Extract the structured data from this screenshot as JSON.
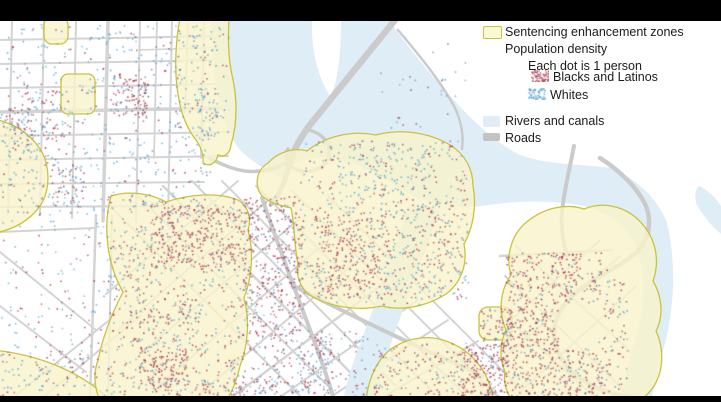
{
  "legend": {
    "items": [
      {
        "label": "Sentencing enhancement zones",
        "swatch": "zone-swatch"
      },
      {
        "label": "Population density",
        "swatch": null
      },
      {
        "label": "Each dot is 1 person",
        "swatch": null
      },
      {
        "label": "Blacks and Latinos",
        "swatch": "red-dots-swatch"
      },
      {
        "label": "Whites",
        "swatch": "blue-dots-swatch"
      },
      {
        "label": "Rivers and canals",
        "swatch": "river-swatch"
      },
      {
        "label": "Roads",
        "swatch": "road-swatch"
      }
    ]
  },
  "colors": {
    "zone_fill": "#F7F3CB",
    "zone_border": "#C9C33C",
    "zone_swatch_fill": "#FBF8D8",
    "river": "#DFEDF6",
    "road": "#D2D2D2",
    "road_major": "#CBCBCB",
    "dot_red": "#A93B50",
    "dot_blue": "#5AA2D0",
    "frame_bar": "#000000",
    "legend_text": "#1B1B1B"
  },
  "map": {
    "dot_unit_label": "Each dot is 1 person",
    "dot_size": 1.5,
    "dot_regions": [
      {
        "name": "grid-main",
        "x": 4,
        "y": 24,
        "w": 206,
        "h": 190,
        "n": 480,
        "red": 0.2
      },
      {
        "name": "red-cluster-a",
        "x": 112,
        "y": 74,
        "w": 36,
        "h": 44,
        "n": 95,
        "red": 0.85
      },
      {
        "name": "red-cluster-b",
        "x": 26,
        "y": 90,
        "w": 42,
        "h": 48,
        "n": 70,
        "red": 0.5
      },
      {
        "name": "red-cluster-c",
        "x": 50,
        "y": 163,
        "w": 34,
        "h": 44,
        "n": 60,
        "red": 0.55
      },
      {
        "name": "red-cluster-d",
        "x": 0,
        "y": 106,
        "w": 28,
        "h": 36,
        "n": 40,
        "red": 0.5
      },
      {
        "name": "shore-blue",
        "x": 196,
        "y": 88,
        "w": 22,
        "h": 48,
        "n": 45,
        "red": 0.1
      },
      {
        "name": "zone3-scatter",
        "x": 176,
        "y": 24,
        "w": 54,
        "h": 118,
        "n": 65,
        "red": 0.25
      },
      {
        "name": "left-mid",
        "x": 0,
        "y": 115,
        "w": 55,
        "h": 98,
        "n": 70,
        "red": 0.42
      },
      {
        "name": "corridor-left",
        "x": 0,
        "y": 212,
        "w": 105,
        "h": 140,
        "n": 115,
        "red": 0.35
      },
      {
        "name": "bl-corner",
        "x": 0,
        "y": 350,
        "w": 112,
        "h": 46,
        "n": 110,
        "red": 0.45
      },
      {
        "name": "z6-base",
        "x": 108,
        "y": 195,
        "w": 140,
        "h": 200,
        "n": 430,
        "red": 0.55
      },
      {
        "name": "z6-redblock",
        "x": 150,
        "y": 205,
        "w": 92,
        "h": 62,
        "n": 280,
        "red": 0.87
      },
      {
        "name": "z6-bluepatch",
        "x": 106,
        "y": 228,
        "w": 46,
        "h": 64,
        "n": 60,
        "red": 0.3
      },
      {
        "name": "z6-mid",
        "x": 126,
        "y": 298,
        "w": 76,
        "h": 48,
        "n": 100,
        "red": 0.6
      },
      {
        "name": "z6-redblock2",
        "x": 138,
        "y": 346,
        "w": 50,
        "h": 40,
        "n": 130,
        "red": 0.88
      },
      {
        "name": "corridor-red",
        "x": 242,
        "y": 196,
        "w": 60,
        "h": 140,
        "n": 400,
        "red": 0.72
      },
      {
        "name": "corridor-low",
        "x": 248,
        "y": 336,
        "w": 84,
        "h": 60,
        "n": 150,
        "red": 0.5
      },
      {
        "name": "z7-base",
        "x": 300,
        "y": 140,
        "w": 168,
        "h": 164,
        "n": 470,
        "red": 0.5
      },
      {
        "name": "z7-bluepatch",
        "x": 330,
        "y": 144,
        "w": 100,
        "h": 52,
        "n": 90,
        "red": 0.25
      },
      {
        "name": "z7-redcore",
        "x": 314,
        "y": 214,
        "w": 74,
        "h": 84,
        "n": 260,
        "red": 0.82
      },
      {
        "name": "z7-east",
        "x": 386,
        "y": 198,
        "w": 76,
        "h": 100,
        "n": 140,
        "red": 0.6
      },
      {
        "name": "corridor-mid",
        "x": 300,
        "y": 330,
        "w": 68,
        "h": 66,
        "n": 90,
        "red": 0.45
      },
      {
        "name": "z8",
        "x": 372,
        "y": 342,
        "w": 136,
        "h": 54,
        "n": 200,
        "red": 0.7
      },
      {
        "name": "z8-redblock",
        "x": 460,
        "y": 344,
        "w": 46,
        "h": 52,
        "n": 140,
        "red": 0.9
      },
      {
        "name": "z9",
        "x": 480,
        "y": 308,
        "w": 32,
        "h": 32,
        "n": 50,
        "red": 0.75
      },
      {
        "name": "z10-a",
        "x": 505,
        "y": 252,
        "w": 96,
        "h": 50,
        "n": 230,
        "red": 0.85
      },
      {
        "name": "z10-b",
        "x": 500,
        "y": 302,
        "w": 58,
        "h": 46,
        "n": 170,
        "red": 0.8
      },
      {
        "name": "z10-c",
        "x": 504,
        "y": 348,
        "w": 98,
        "h": 48,
        "n": 260,
        "red": 0.78
      },
      {
        "name": "z10-east",
        "x": 598,
        "y": 268,
        "w": 30,
        "h": 128,
        "n": 80,
        "red": 0.55
      },
      {
        "name": "bridge-land",
        "x": 380,
        "y": 40,
        "w": 86,
        "h": 96,
        "n": 28,
        "red": 0.3
      },
      {
        "name": "bottom-strip",
        "x": 150,
        "y": 378,
        "w": 130,
        "h": 18,
        "n": 90,
        "red": 0.6
      }
    ]
  }
}
